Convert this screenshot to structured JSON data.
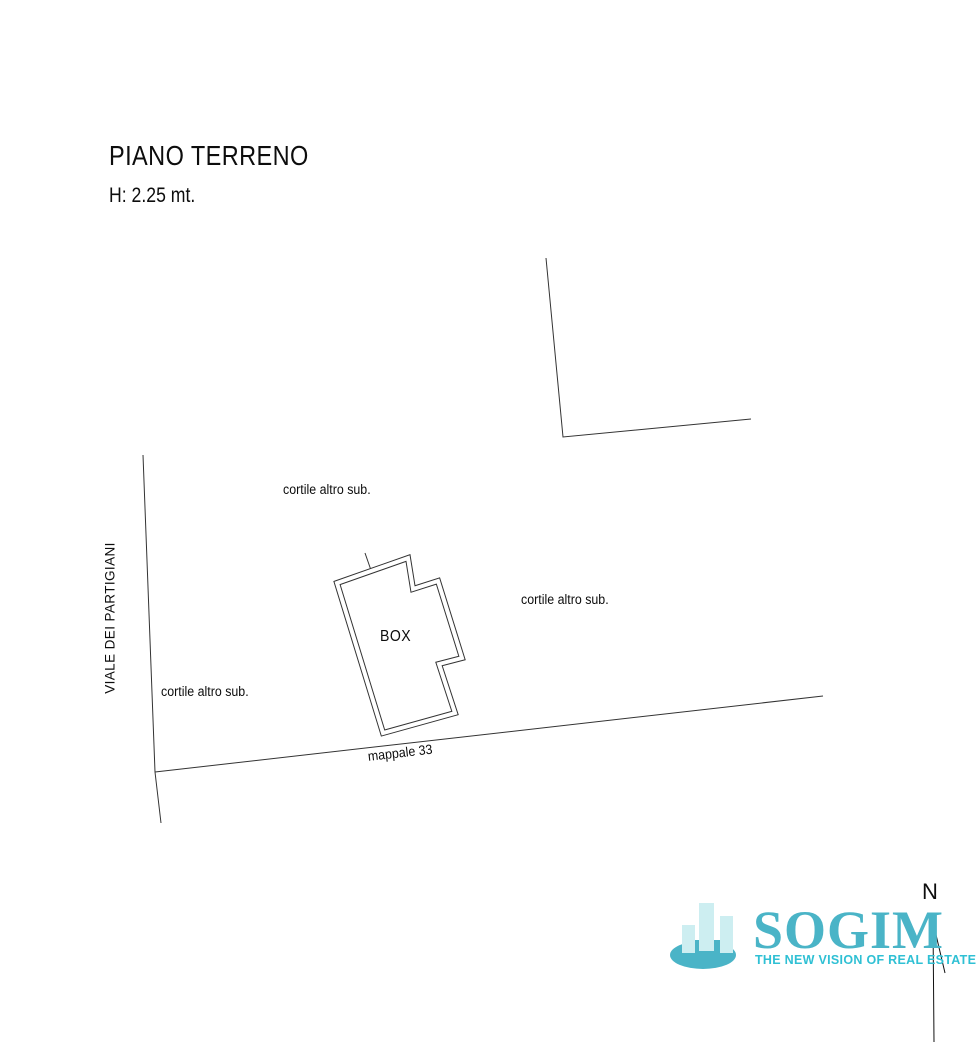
{
  "header": {
    "title": "PIANO TERRENO",
    "height_note": "H: 2.25 mt."
  },
  "plan": {
    "street_label": "VIALE DEI PARTIGIANI",
    "courtyard_top_label": "cortile altro sub.",
    "courtyard_right_label": "cortile altro sub.",
    "courtyard_left_label": "cortile altro sub.",
    "parcel_label": "mappale 33",
    "building_label": "BOX",
    "line_color": "#333333"
  },
  "compass": {
    "north_label": "N"
  },
  "logo": {
    "wordmark": "SOGIM",
    "tagline": "THE NEW VISION OF REAL ESTATE",
    "colors": {
      "primary": "#4ab4c7",
      "light": "#cdeef1",
      "tagline": "#2fc0d4"
    }
  }
}
